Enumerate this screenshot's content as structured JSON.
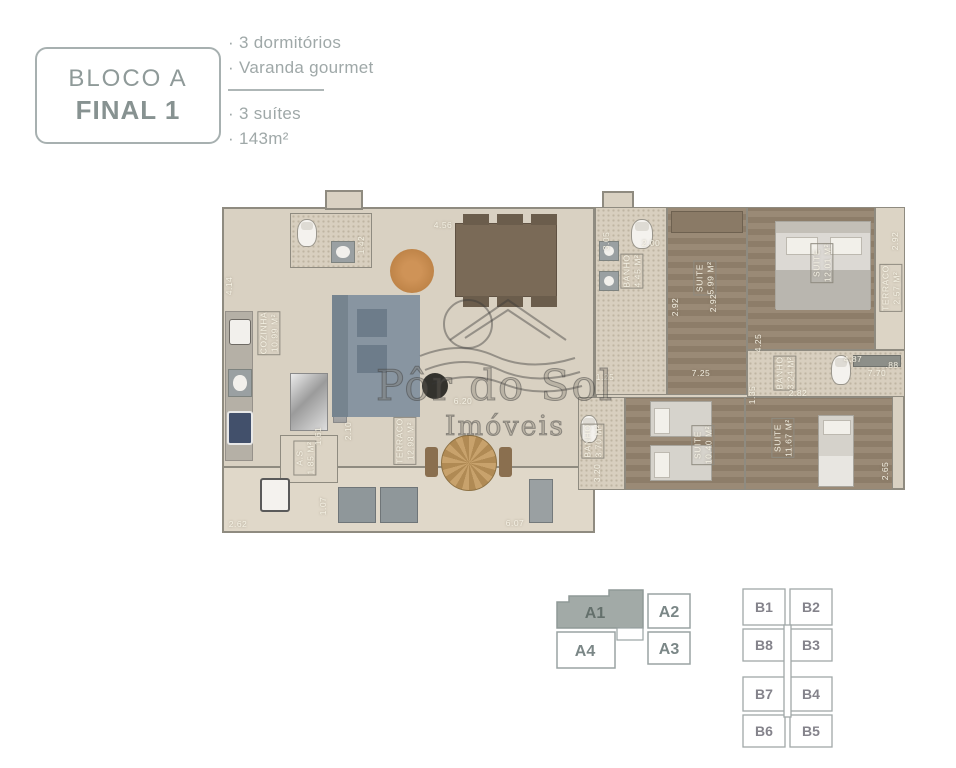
{
  "header": {
    "block_label": "BLOCO A",
    "final_label": "FINAL 1"
  },
  "features": {
    "items": [
      "· 3 dormitórios",
      "· Varanda gourmet",
      "· 3 suítes",
      "· 143m²"
    ]
  },
  "watermark": {
    "line1": "Pôr do Sol",
    "line2": "Imóveis"
  },
  "floorplan": {
    "labels": [
      {
        "k": "room",
        "t": "COZINHA\n10.99 M²",
        "x": 84,
        "y": 150,
        "r": -90
      },
      {
        "k": "room",
        "t": "BANHO\n4.45 M²",
        "x": 447,
        "y": 88,
        "r": -90
      },
      {
        "k": "room",
        "t": "SUITE\n5.99 M²",
        "x": 520,
        "y": 95,
        "r": -90
      },
      {
        "k": "room",
        "t": "SUITE\n12.01 M²",
        "x": 637,
        "y": 80,
        "r": -90
      },
      {
        "k": "room",
        "t": "TERRACO\n2.57 M²",
        "x": 706,
        "y": 105,
        "r": -90
      },
      {
        "k": "room",
        "t": "BANHO\n3.24 M²",
        "x": 600,
        "y": 190,
        "r": -90
      },
      {
        "k": "room",
        "t": "SUITE\n10.40 M²",
        "x": 518,
        "y": 262,
        "r": -90
      },
      {
        "k": "room",
        "t": "SUITE\n11.67 M²",
        "x": 598,
        "y": 255,
        "r": -90
      },
      {
        "k": "room",
        "t": "BANHO\n3.70 M²",
        "x": 408,
        "y": 258,
        "r": -90
      },
      {
        "k": "room",
        "t": "A.S\n1.85 M²",
        "x": 120,
        "y": 275,
        "r": -90
      },
      {
        "k": "room",
        "t": "TERRACO\n12.98 M²",
        "x": 220,
        "y": 258,
        "r": -90
      },
      {
        "k": "dim",
        "t": "4.14",
        "x": 44,
        "y": 103,
        "r": -90
      },
      {
        "k": "dim",
        "t": "1.42",
        "x": 176,
        "y": 62,
        "r": -90
      },
      {
        "k": "dim",
        "t": "4.56",
        "x": 258,
        "y": 42,
        "r": 0
      },
      {
        "k": "dim",
        "t": "3.05",
        "x": 421,
        "y": 58,
        "r": -90
      },
      {
        "k": "dim",
        "t": "2.00",
        "x": 466,
        "y": 60,
        "r": 0
      },
      {
        "k": "dim",
        "t": "2.92",
        "x": 490,
        "y": 124,
        "r": -90
      },
      {
        "k": "dim",
        "t": "2.92",
        "x": 528,
        "y": 120,
        "r": -90
      },
      {
        "k": "dim",
        "t": "2.92",
        "x": 710,
        "y": 58,
        "r": -90
      },
      {
        "k": "dim",
        "t": "4.87",
        "x": 668,
        "y": 176,
        "r": 0
      },
      {
        "k": "dim",
        "t": ".88",
        "x": 707,
        "y": 182,
        "r": 0
      },
      {
        "k": "dim",
        "t": "4.25",
        "x": 573,
        "y": 160,
        "r": -90
      },
      {
        "k": "dim",
        "t": "7.70",
        "x": 692,
        "y": 190,
        "r": 0
      },
      {
        "k": "dim",
        "t": "1.35",
        "x": 567,
        "y": 212,
        "r": -90
      },
      {
        "k": "dim",
        "t": "2.82",
        "x": 613,
        "y": 210,
        "r": 0
      },
      {
        "k": "dim",
        "t": "1.25",
        "x": 420,
        "y": 194,
        "r": 0
      },
      {
        "k": "dim",
        "t": "7.25",
        "x": 516,
        "y": 190,
        "r": 0
      },
      {
        "k": "dim",
        "t": "3.20",
        "x": 412,
        "y": 290,
        "r": -90
      },
      {
        "k": "dim",
        "t": "2.65",
        "x": 700,
        "y": 288,
        "r": -90
      },
      {
        "k": "dim",
        "t": "1.61",
        "x": 133,
        "y": 253,
        "r": -90
      },
      {
        "k": "dim",
        "t": "2.10",
        "x": 163,
        "y": 248,
        "r": -90
      },
      {
        "k": "dim",
        "t": "1.07",
        "x": 138,
        "y": 323,
        "r": -90
      },
      {
        "k": "dim",
        "t": "2.62",
        "x": 53,
        "y": 341,
        "r": 0
      },
      {
        "k": "dim",
        "t": "6.07",
        "x": 330,
        "y": 340,
        "r": 0
      },
      {
        "k": "dim",
        "t": "6.20",
        "x": 278,
        "y": 218,
        "r": 0
      }
    ]
  },
  "blocks": {
    "a": {
      "highlighted_unit": "A1",
      "highlight_color": "#a2aaa7",
      "units": [
        "A1",
        "A2",
        "A4",
        "A3"
      ]
    },
    "b": {
      "units": [
        "B1",
        "B2",
        "B8",
        "B3",
        "B7",
        "B4",
        "B6",
        "B5"
      ]
    }
  }
}
